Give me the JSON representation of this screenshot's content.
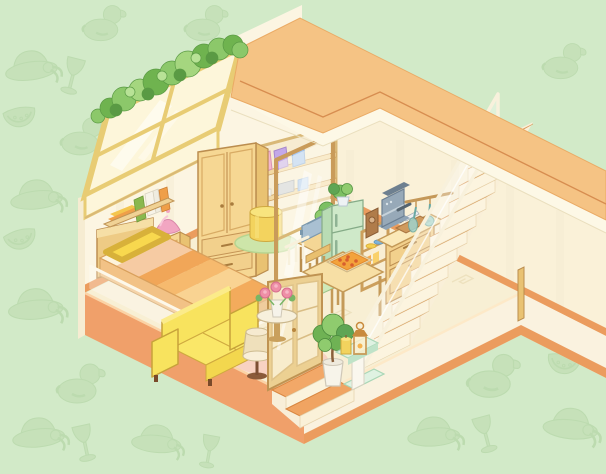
{
  "scene_type": "isometric-room",
  "palette": {
    "background": "#d2eac8",
    "pattern_fill": "#c3dfb6",
    "pattern_line": "#b7d7a9",
    "roof": "#f5c384",
    "roof_edge_line": "#d4874a",
    "roof_rim": "#fdf8e6",
    "wall_left": "#fcf5e2",
    "wall_right": "#faf1d8",
    "baseboard": "#eb9c5e",
    "floor": "#f8efd4",
    "floor_motif": "#ece0bc",
    "slab_salmon": "#f0a06a",
    "slab_cream": "#faf2df",
    "wood_light": "#f6d793",
    "wood_mid": "#e9c272",
    "wood_dark": "#bb8d4f",
    "glass_frame": "#e8cc74",
    "glass_pane": "#fdf6da",
    "greenery_a": "#8cc86a",
    "greenery_b": "#6fb34f",
    "greenery_c": "#a5d67f",
    "fridge": "#cfe9c9",
    "fridge_side": "#b9dcb4",
    "fridge_line": "#85ab87",
    "espresso": "#97a9b8",
    "toaster": "#a9c0d2",
    "teal_utensil": "#9fd3cd",
    "pouf": "#f3d35e",
    "rug_green": "#cde5a9",
    "rug_pink": "#f8d2c2",
    "pillow": "#f8d84e",
    "sofa": "#f8e35e",
    "lamp_shade": "#efe0bb",
    "lamp_pink": "#f2a6c2",
    "door_wood": "#ecd092",
    "rose_pink": "#ee8fa6",
    "plant_green": "#6fb254",
    "stand_mint": "#dff2e2",
    "candle": "#f2d35e",
    "stair_tread": "#f4bb7d",
    "stair_riser": "#fcf4df",
    "railing": "#f8f1dc",
    "bag_pink": "#f4b6ce",
    "bag_purple": "#c3a8e8",
    "bag_blue": "#a9c9f2",
    "bed_stripes": [
      "#fdf3dc",
      "#f6cba3",
      "#f1a658",
      "#f6ba6e",
      "#f9d392",
      "#f3ab5c"
    ]
  },
  "background": {
    "motifs": [
      "rubber-duck",
      "sun-hat",
      "wine-glass",
      "watermelon-slice"
    ]
  },
  "scene": {
    "items": [
      {
        "id": "skylight-window",
        "label": "Slanted skylight window with bushes on top"
      },
      {
        "id": "wardrobe",
        "label": "Wooden wardrobe with two doors and two drawers"
      },
      {
        "id": "closet-shelves",
        "label": "Closet nook shelves with pink, purple and blue bags"
      },
      {
        "id": "glass-partition",
        "label": "Glass partition panel"
      },
      {
        "id": "pouf",
        "label": "Yellow cylindrical pouf on round green rug"
      },
      {
        "id": "bed",
        "label": "Bed with striped orange duvet and yellow pillow"
      },
      {
        "id": "nightstand",
        "label": "Nightstand with pink table lamp"
      },
      {
        "id": "wall-shelf",
        "label": "Wall shelf with books"
      },
      {
        "id": "sofa",
        "label": "Yellow sofa on pink round rug"
      },
      {
        "id": "floor-lamp",
        "label": "Floor lamp with beige shade"
      },
      {
        "id": "fridge",
        "label": "Mint refrigerator with plant on top"
      },
      {
        "id": "toaster",
        "label": "Blue toaster on side table with potted plant"
      },
      {
        "id": "espresso-machine",
        "label": "Espresso machine and wooden grinder on cabinet"
      },
      {
        "id": "utensil-rail",
        "label": "Hanging rail with teal utensils"
      },
      {
        "id": "kitchen-counter",
        "label": "Counter with cutting board and knife"
      },
      {
        "id": "dish-shelf",
        "label": "Open shelf with plates and jars"
      },
      {
        "id": "dining-table",
        "label": "Dining table with pizza"
      },
      {
        "id": "dining-chair",
        "label": "Wooden chair with mint seat"
      },
      {
        "id": "staircase",
        "label": "Staircase with acrylic railing along right wall"
      },
      {
        "id": "entry-door",
        "label": "Glass-paned entry door"
      },
      {
        "id": "entry-steps",
        "label": "Two entry steps with orange treads"
      },
      {
        "id": "flower-table",
        "label": "Round side table with pink roses"
      },
      {
        "id": "houseplant",
        "label": "Potted plant in white pot"
      },
      {
        "id": "display-stand",
        "label": "Mint display stand with candle and lantern"
      }
    ]
  }
}
